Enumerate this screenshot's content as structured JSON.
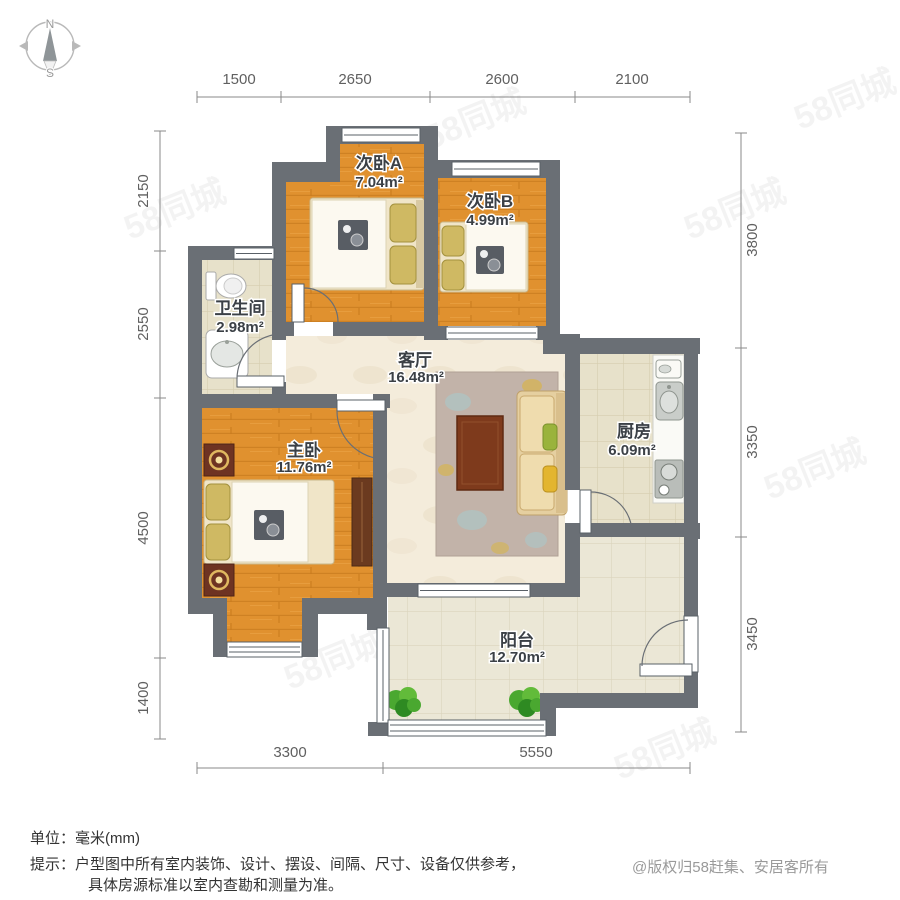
{
  "compass": {
    "north": "N",
    "south": "S"
  },
  "rooms": {
    "bedroom_a": {
      "name": "次卧A",
      "area": "7.04m²"
    },
    "bedroom_b": {
      "name": "次卧B",
      "area": "4.99m²"
    },
    "bathroom": {
      "name": "卫生间",
      "area": "2.98m²"
    },
    "living": {
      "name": "客厅",
      "area": "16.48m²"
    },
    "master": {
      "name": "主卧",
      "area": "11.76m²"
    },
    "kitchen": {
      "name": "厨房",
      "area": "6.09m²"
    },
    "balcony": {
      "name": "阳台",
      "area": "12.70m²"
    }
  },
  "dimensions": {
    "top": [
      "1500",
      "2650",
      "2600",
      "2100"
    ],
    "left": [
      "2150",
      "2550",
      "4500",
      "1400"
    ],
    "right": [
      "3800",
      "3350",
      "3450"
    ],
    "bottom": [
      "3300",
      "5550"
    ]
  },
  "footer": {
    "unit_line": "单位：毫米(mm)",
    "tip_line1": "提示：户型图中所有室内装饰、设计、摆设、间隔、尺寸、设备仅供参考，",
    "tip_line2": "具体房源标准以室内查勘和测量为准。",
    "copyright": "@版权归58赶集、安居客所有"
  },
  "watermark": {
    "text": "58同城"
  },
  "colors": {
    "wall": "#6a6f75",
    "wood_floor": "#e0912f",
    "tile_floor": "#e7e1ca",
    "living_floor": "#f4ecdb",
    "balcony_floor": "#ebe7d6",
    "window": "#ffffff",
    "sofa": "#e5cfa0",
    "rug": "#c2b3a9",
    "coffee_table": "#7e3a1c",
    "plant": "#4aa830",
    "lamp": "#e0b860",
    "label_text": "#3b4046",
    "dimension_text": "#606060",
    "copyright_text": "#9a9a9a"
  }
}
